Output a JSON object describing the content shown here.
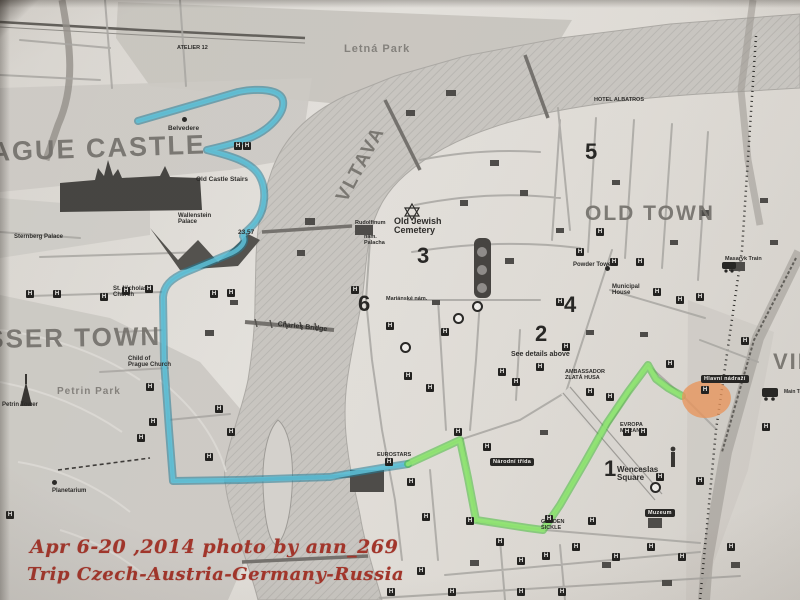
{
  "photo": {
    "caption": {
      "line1": "Apr 6-20 ,2014  photo by ann_269",
      "line2": "Trip  Czech-Austria-Germany-Russia",
      "color": "#9e2a20"
    }
  },
  "map": {
    "hotel_glyph": "H",
    "routes": {
      "blue_edge": "rgba(23,118,148,0.55)",
      "blue_core": "rgba(88,198,224,0.80)",
      "green_edge": "rgba(58,188,48,0.55)",
      "green_core": "rgba(142,234,110,0.85)",
      "orange_fill": "rgba(232,146,88,0.80)"
    },
    "labels": [
      {
        "kind": "district",
        "text": "AGUE CASTLE",
        "x": -10,
        "y": 138,
        "size": 27,
        "rot": -2
      },
      {
        "kind": "district",
        "text": "SSER TOWN",
        "x": -14,
        "y": 326,
        "size": 26,
        "rot": -1
      },
      {
        "kind": "district",
        "text": "OLD TOWN",
        "x": 585,
        "y": 203,
        "size": 21,
        "rot": 0
      },
      {
        "kind": "district",
        "text": "VLTAVA",
        "x": 333,
        "y": 196,
        "size": 19,
        "rot": -62
      },
      {
        "kind": "district",
        "text": "VIN",
        "x": 773,
        "y": 350,
        "size": 22,
        "rot": 0
      },
      {
        "kind": "area",
        "text": "Letná Park",
        "x": 344,
        "y": 44,
        "size": 11,
        "rot": 0
      },
      {
        "kind": "area",
        "text": "Petrin Park",
        "x": 57,
        "y": 387,
        "size": 10,
        "rot": 0
      },
      {
        "kind": "number",
        "text": "5",
        "x": 585,
        "y": 140,
        "size": 22,
        "rot": 0
      },
      {
        "kind": "number",
        "text": "3",
        "x": 417,
        "y": 244,
        "size": 22,
        "rot": 0
      },
      {
        "kind": "number",
        "text": "6",
        "x": 358,
        "y": 292,
        "size": 22,
        "rot": 0
      },
      {
        "kind": "number",
        "text": "4",
        "x": 564,
        "y": 293,
        "size": 22,
        "rot": 0
      },
      {
        "kind": "number",
        "text": "2",
        "x": 535,
        "y": 322,
        "size": 22,
        "rot": 0
      },
      {
        "kind": "number",
        "text": "1",
        "x": 604,
        "y": 457,
        "size": 22,
        "rot": 0
      },
      {
        "kind": "place",
        "text": "Belvedere",
        "x": 168,
        "y": 126,
        "size": 6.5,
        "rot": 0
      },
      {
        "kind": "place",
        "text": "Old Castle Stairs",
        "x": 196,
        "y": 177,
        "size": 6.5,
        "rot": 0
      },
      {
        "kind": "place",
        "text": "Wallenstein\nPalace",
        "x": 178,
        "y": 213,
        "size": 6,
        "rot": 0
      },
      {
        "kind": "place",
        "text": "Sternberg Palace",
        "x": 14,
        "y": 234,
        "size": 6,
        "rot": 0
      },
      {
        "kind": "place",
        "text": "St. Nicholas\nChurch",
        "x": 113,
        "y": 286,
        "size": 6,
        "rot": 0
      },
      {
        "kind": "place",
        "text": "Old Jewish\nCemetery",
        "x": 394,
        "y": 217,
        "size": 9,
        "rot": 0
      },
      {
        "kind": "place",
        "text": "Rudolfinum",
        "x": 355,
        "y": 221,
        "size": 5.5,
        "rot": 0
      },
      {
        "kind": "place",
        "text": "nám.\nPalacha",
        "x": 364,
        "y": 235,
        "size": 5.5,
        "rot": 0
      },
      {
        "kind": "place",
        "text": "Mariánské nám.",
        "x": 386,
        "y": 297,
        "size": 5.5,
        "rot": 0
      },
      {
        "kind": "place",
        "text": "Charles Bridge",
        "x": 278,
        "y": 321,
        "size": 7,
        "rot": 6
      },
      {
        "kind": "place",
        "text": "Child of\nPrague Church",
        "x": 128,
        "y": 356,
        "size": 6,
        "rot": 0
      },
      {
        "kind": "place",
        "text": "Petrin Tower",
        "x": 2,
        "y": 402,
        "size": 6,
        "rot": 0
      },
      {
        "kind": "place",
        "text": "Planetarium",
        "x": 52,
        "y": 488,
        "size": 6,
        "rot": 0
      },
      {
        "kind": "place",
        "text": "Powder Tower",
        "x": 573,
        "y": 262,
        "size": 6,
        "rot": 0
      },
      {
        "kind": "place",
        "text": "Municipal\nHouse",
        "x": 612,
        "y": 284,
        "size": 6,
        "rot": 0
      },
      {
        "kind": "place",
        "text": "Masaryk Train",
        "x": 725,
        "y": 257,
        "size": 5.5,
        "rot": 0
      },
      {
        "kind": "place",
        "text": "Wenceslas\nSquare",
        "x": 617,
        "y": 466,
        "size": 8,
        "rot": 0
      },
      {
        "kind": "place",
        "text": "See details above",
        "x": 511,
        "y": 351,
        "size": 7,
        "rot": 0
      },
      {
        "kind": "place",
        "text": "EUROSTARS",
        "x": 377,
        "y": 453,
        "size": 5.5,
        "rot": 0
      },
      {
        "kind": "place",
        "text": "GOLDEN\nSICKLE",
        "x": 541,
        "y": 520,
        "size": 5.5,
        "rot": 0
      },
      {
        "kind": "place",
        "text": "EVROPA\nMERAN",
        "x": 620,
        "y": 423,
        "size": 5.5,
        "rot": 0
      },
      {
        "kind": "place",
        "text": "AMBASSADOR\nZLATÁ HUSA",
        "x": 565,
        "y": 370,
        "size": 5.5,
        "rot": 0
      },
      {
        "kind": "place",
        "text": "HOTEL ALBATROS",
        "x": 594,
        "y": 98,
        "size": 5.5,
        "rot": 0
      },
      {
        "kind": "place",
        "text": "ATELIER 12",
        "x": 177,
        "y": 46,
        "size": 5.5,
        "rot": 0
      },
      {
        "kind": "place",
        "text": "23,57",
        "x": 238,
        "y": 230,
        "size": 6.5,
        "rot": 0
      },
      {
        "kind": "place",
        "text": "Main Tr",
        "x": 784,
        "y": 390,
        "size": 5,
        "rot": 0
      }
    ],
    "badges": [
      {
        "text": "Hlavní nádraží",
        "x": 701,
        "y": 375
      },
      {
        "text": "Národní třída",
        "x": 490,
        "y": 458
      },
      {
        "text": "Muzeum",
        "x": 645,
        "y": 509
      }
    ],
    "hotel_markers": [
      [
        247,
        146
      ],
      [
        30,
        294
      ],
      [
        57,
        294
      ],
      [
        104,
        297
      ],
      [
        126,
        291
      ],
      [
        149,
        289
      ],
      [
        214,
        294
      ],
      [
        231,
        293
      ],
      [
        150,
        387
      ],
      [
        153,
        422
      ],
      [
        219,
        409
      ],
      [
        231,
        432
      ],
      [
        141,
        438
      ],
      [
        209,
        457
      ],
      [
        355,
        290
      ],
      [
        390,
        326
      ],
      [
        408,
        376
      ],
      [
        430,
        388
      ],
      [
        445,
        332
      ],
      [
        458,
        432
      ],
      [
        487,
        447
      ],
      [
        502,
        372
      ],
      [
        516,
        382
      ],
      [
        540,
        367
      ],
      [
        560,
        302
      ],
      [
        580,
        252
      ],
      [
        600,
        232
      ],
      [
        614,
        262
      ],
      [
        640,
        262
      ],
      [
        657,
        292
      ],
      [
        680,
        300
      ],
      [
        700,
        297
      ],
      [
        566,
        347
      ],
      [
        590,
        392
      ],
      [
        610,
        397
      ],
      [
        627,
        432
      ],
      [
        643,
        432
      ],
      [
        660,
        477
      ],
      [
        411,
        482
      ],
      [
        426,
        517
      ],
      [
        470,
        521
      ],
      [
        500,
        542
      ],
      [
        521,
        561
      ],
      [
        546,
        556
      ],
      [
        576,
        547
      ],
      [
        592,
        521
      ],
      [
        616,
        557
      ],
      [
        651,
        547
      ],
      [
        682,
        557
      ],
      [
        700,
        481
      ],
      [
        731,
        547
      ],
      [
        421,
        571
      ],
      [
        452,
        592
      ],
      [
        391,
        592
      ],
      [
        521,
        592
      ],
      [
        562,
        592
      ],
      [
        766,
        427
      ],
      [
        745,
        341
      ],
      [
        389,
        462
      ],
      [
        549,
        519
      ],
      [
        705,
        390
      ],
      [
        670,
        364
      ],
      [
        10,
        515
      ],
      [
        238,
        146
      ]
    ],
    "metro_rings": [
      [
        458,
        318
      ],
      [
        405,
        347
      ],
      [
        477,
        306
      ],
      [
        655,
        487
      ]
    ],
    "poi_dots": [
      [
        184,
        119
      ],
      [
        54,
        482
      ],
      [
        607,
        268
      ]
    ]
  }
}
